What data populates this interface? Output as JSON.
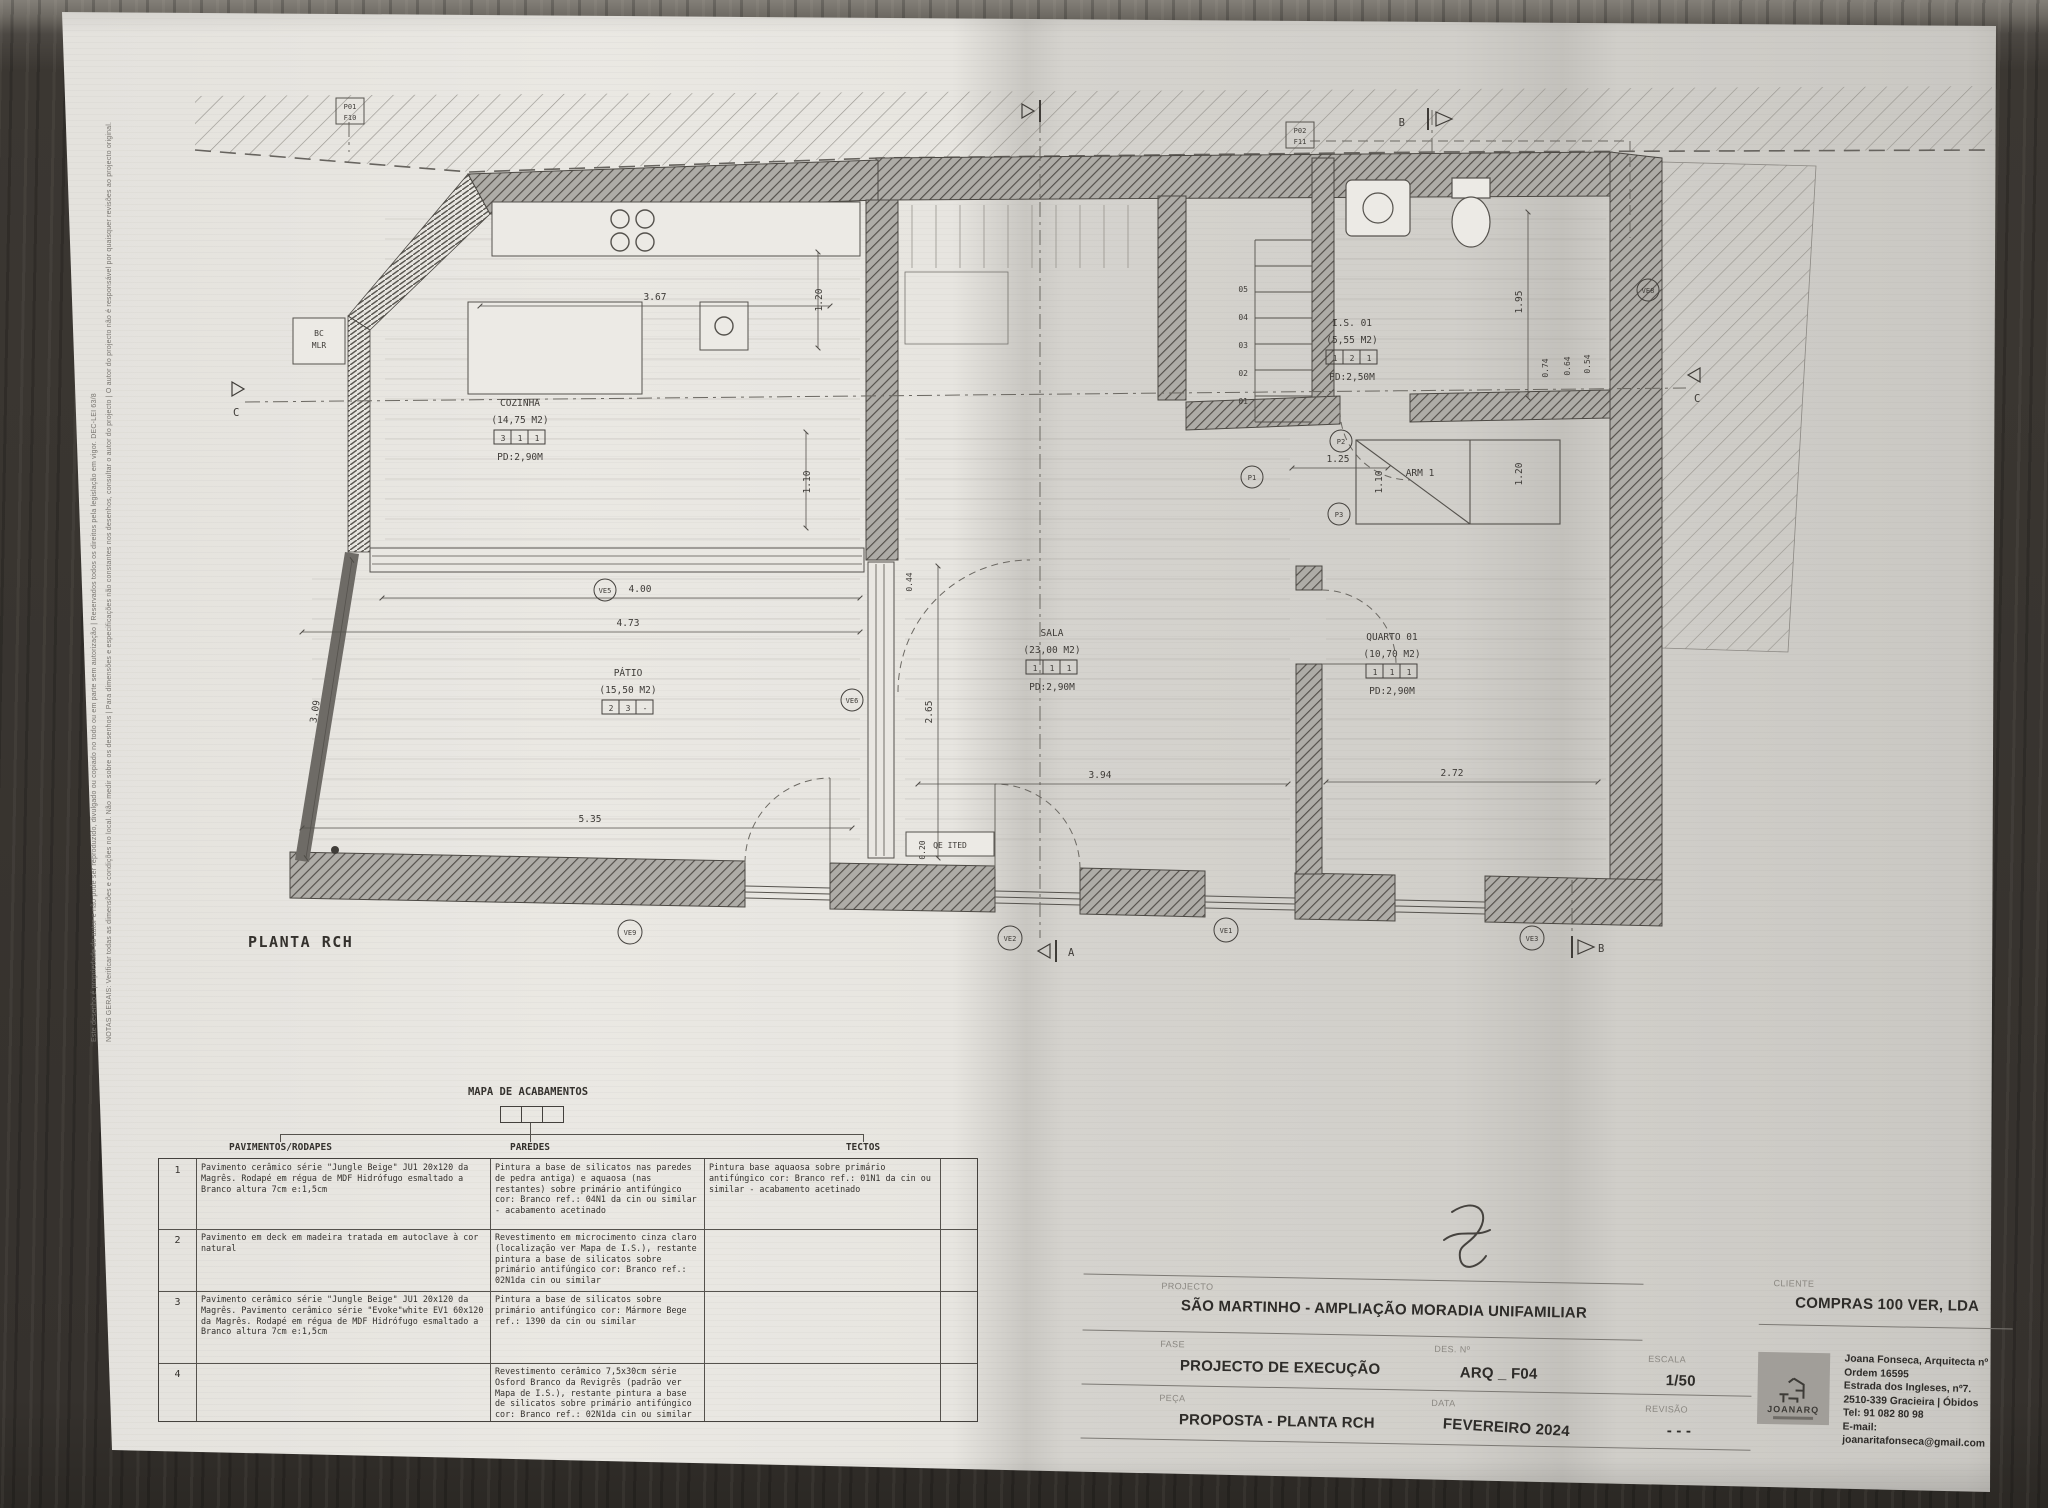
{
  "plan": {
    "title": "PLANTA RCH",
    "rooms": [
      {
        "name": "COZINHA",
        "area": "(14,75 M2)",
        "codes": [
          "3",
          "1",
          "1"
        ],
        "pd": "PD:2,90M"
      },
      {
        "name": "PÁTIO",
        "area": "(15,50 M2)",
        "codes": [
          "2",
          "3",
          "-"
        ],
        "pd": ""
      },
      {
        "name": "SALA",
        "area": "(23,00 M2)",
        "codes": [
          "1",
          "1",
          "1"
        ],
        "pd": "PD:2,90M"
      },
      {
        "name": "QUARTO 01",
        "area": "(10,70 M2)",
        "codes": [
          "1",
          "1",
          "1"
        ],
        "pd": "PD:2,90M"
      },
      {
        "name": "I.S. 01",
        "area": "(5,55 M2)",
        "codes": [
          "1",
          "2",
          "1"
        ],
        "pd": "PD:2,50M"
      }
    ],
    "labels": {
      "arm": "ARM 1",
      "bc": "BC",
      "mlr": "MLR",
      "ited": "QE ITED"
    },
    "ref1": {
      "l1": "P01",
      "l2": "F10"
    },
    "ref2": {
      "l1": "P02",
      "l2": "F11"
    },
    "dims": [
      "3.67",
      "1.20",
      "1.10",
      "4.00",
      "4.73",
      "2.65",
      "3.09",
      "5.35",
      "3.94",
      "2.72",
      "1.95",
      "0.74",
      "0.64",
      "0.54",
      "1.25",
      "1.10",
      "1.20",
      "0.44",
      "0.20"
    ],
    "ve_markers": [
      "VE9",
      "VE2",
      "VE1",
      "VE3",
      "VE5",
      "VE6",
      "VE8"
    ],
    "p_markers": [
      "P1",
      "P2",
      "P3"
    ],
    "stairs": [
      "05",
      "04",
      "03",
      "02",
      "01"
    ],
    "sections": {
      "a": "A",
      "b": "B",
      "c": "C"
    }
  },
  "notes": {
    "line1": "NOTAS GERAIS: Verificar todas as dimensões e condições no local. Não medir sobre os desenhos | Para dimensões e especificações não constantes nos desenhos, consultar o autor do projecto | O autor do projecto não é responsável por quaisquer revisões ao projecto original.",
    "line2": "Este desenho é propriedade do autor e não pode ser reproduzido, divulgado ou copiado no todo ou em parte sem autorização | Reservados todos os direitos pela legislação em vigor. DEC-LEI 63/8"
  },
  "finishes_table": {
    "title": "MAPA DE ACABAMENTOS",
    "headers": [
      "PAVIMENTOS/RODAPES",
      "PAREDES",
      "TECTOS"
    ],
    "rows": [
      {
        "num": "1",
        "pavimentos": "Pavimento cerâmico série \"Jungle Beige\" JU1 20x120 da Magrês. Rodapé em régua de MDF Hidrófugo esmaltado a Branco altura 7cm e:1,5cm",
        "paredes": "Pintura a base de silicatos nas paredes de pedra antiga) e aquaosa (nas restantes) sobre primário antifúngico cor: Branco ref.: 04N1 da cin ou similar - acabamento acetinado",
        "tectos": "Pintura base aquaosa sobre primário antifúngico cor: Branco ref.: 01N1 da cin ou similar - acabamento acetinado"
      },
      {
        "num": "2",
        "pavimentos": "Pavimento em deck em madeira tratada em autoclave à cor natural",
        "paredes": "Revestimento em microcimento cinza claro (localização ver Mapa de I.S.), restante pintura a base de silicatos sobre primário antifúngico cor: Branco ref.: 02N1da cin ou similar",
        "tectos": ""
      },
      {
        "num": "3",
        "pavimentos": "Pavimento cerâmico série \"Jungle Beige\" JU1 20x120 da Magrês. Pavimento cerâmico série \"Evoke\"white EV1 60x120 da Magrês. Rodapé em régua de MDF Hidrófugo esmaltado a Branco altura 7cm e:1,5cm",
        "paredes": "Pintura a base de silicatos sobre primário antifúngico cor: Mármore Bege ref.: 1390 da cin ou similar",
        "tectos": ""
      },
      {
        "num": "4",
        "pavimentos": "",
        "paredes": "Revestimento cerâmico 7,5x30cm série Osford Branco da Revigrês (padrão ver Mapa de I.S.), restante pintura a base de silicatos sobre primário antifúngico cor: Branco ref.: 02N1da cin ou similar",
        "tectos": ""
      }
    ]
  },
  "title_block": {
    "projecto_label": "PROJECTO",
    "projecto": "SÃO MARTINHO - AMPLIAÇÃO MORADIA UNIFAMILIAR",
    "fase_label": "FASE",
    "fase": "PROJECTO DE EXECUÇÃO",
    "peca_label": "PEÇA",
    "peca": "PROPOSTA - PLANTA RCH",
    "des_label": "DES. Nº",
    "des": "ARQ _ F04",
    "data_label": "DATA",
    "data": "FEVEREIRO 2024",
    "escala_label": "ESCALA",
    "escala": "1/50",
    "revisao_label": "REVISÃO",
    "revisao": "- - -",
    "cliente_label": "CLIENTE",
    "cliente": "COMPRAS 100 VER, LDA",
    "logo": "JOANARQ",
    "contact": [
      "Joana Fonseca, Arquitecta nº Ordem 16595",
      "Estrada dos Ingleses, nº7.",
      "2510-339 Gracieira | Óbidos",
      "Tel: 91 082 80 98",
      "E-mail: joanaritafonseca@gmail.com"
    ]
  }
}
